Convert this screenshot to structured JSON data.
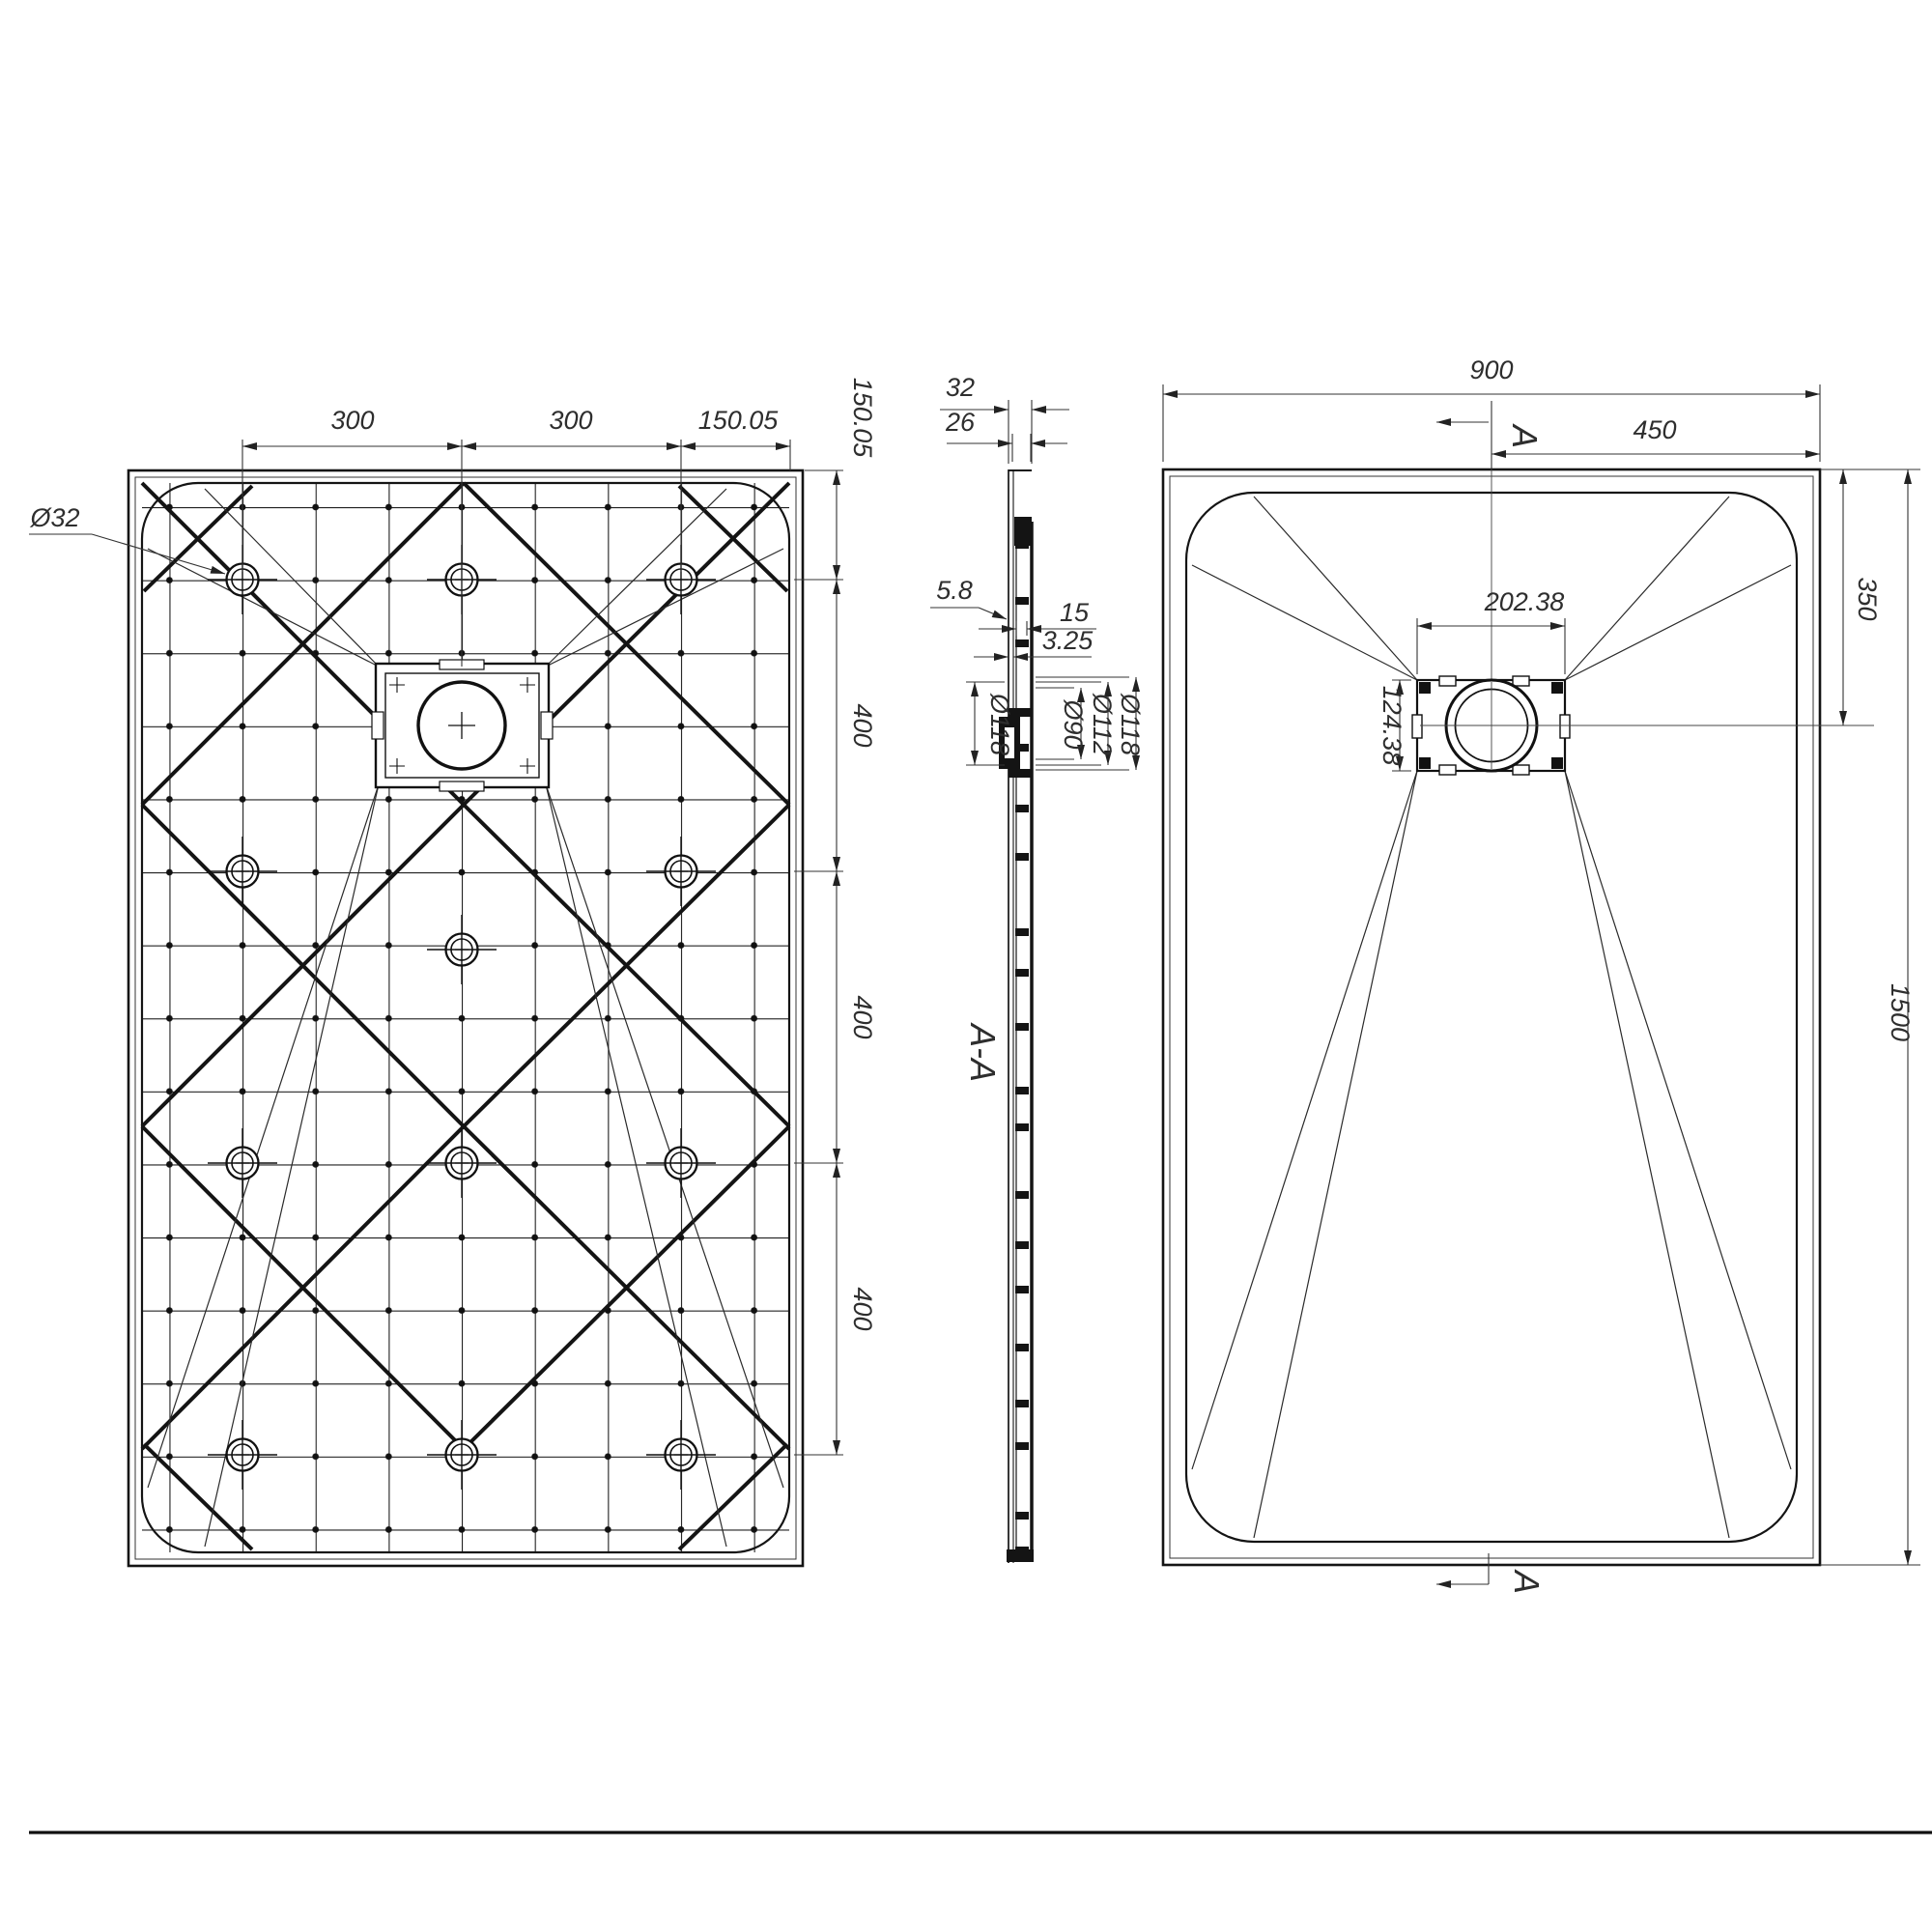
{
  "drawing": {
    "type": "shower-tray technical drawing, three views",
    "footer_rule": true
  },
  "labels": {
    "bottom": {
      "w1": "300",
      "w2": "300",
      "w3": "150.05",
      "h0": "150.05",
      "h1": "400",
      "h2": "400",
      "h3": "400",
      "boss_dia": "Ø32"
    },
    "section": {
      "t1": "32",
      "t2": "26",
      "s1": "5.8",
      "s2": "15",
      "s3": "3.25",
      "d1": "Ø118",
      "d2": "Ø90",
      "d3": "Ø112",
      "d4": "Ø118",
      "name": "A-A"
    },
    "top": {
      "w": "900",
      "wc": "450",
      "hc": "350",
      "h": "1500",
      "dw": "202.38",
      "dh": "124.38",
      "sec_top": "A",
      "sec_bottom": "A"
    }
  }
}
